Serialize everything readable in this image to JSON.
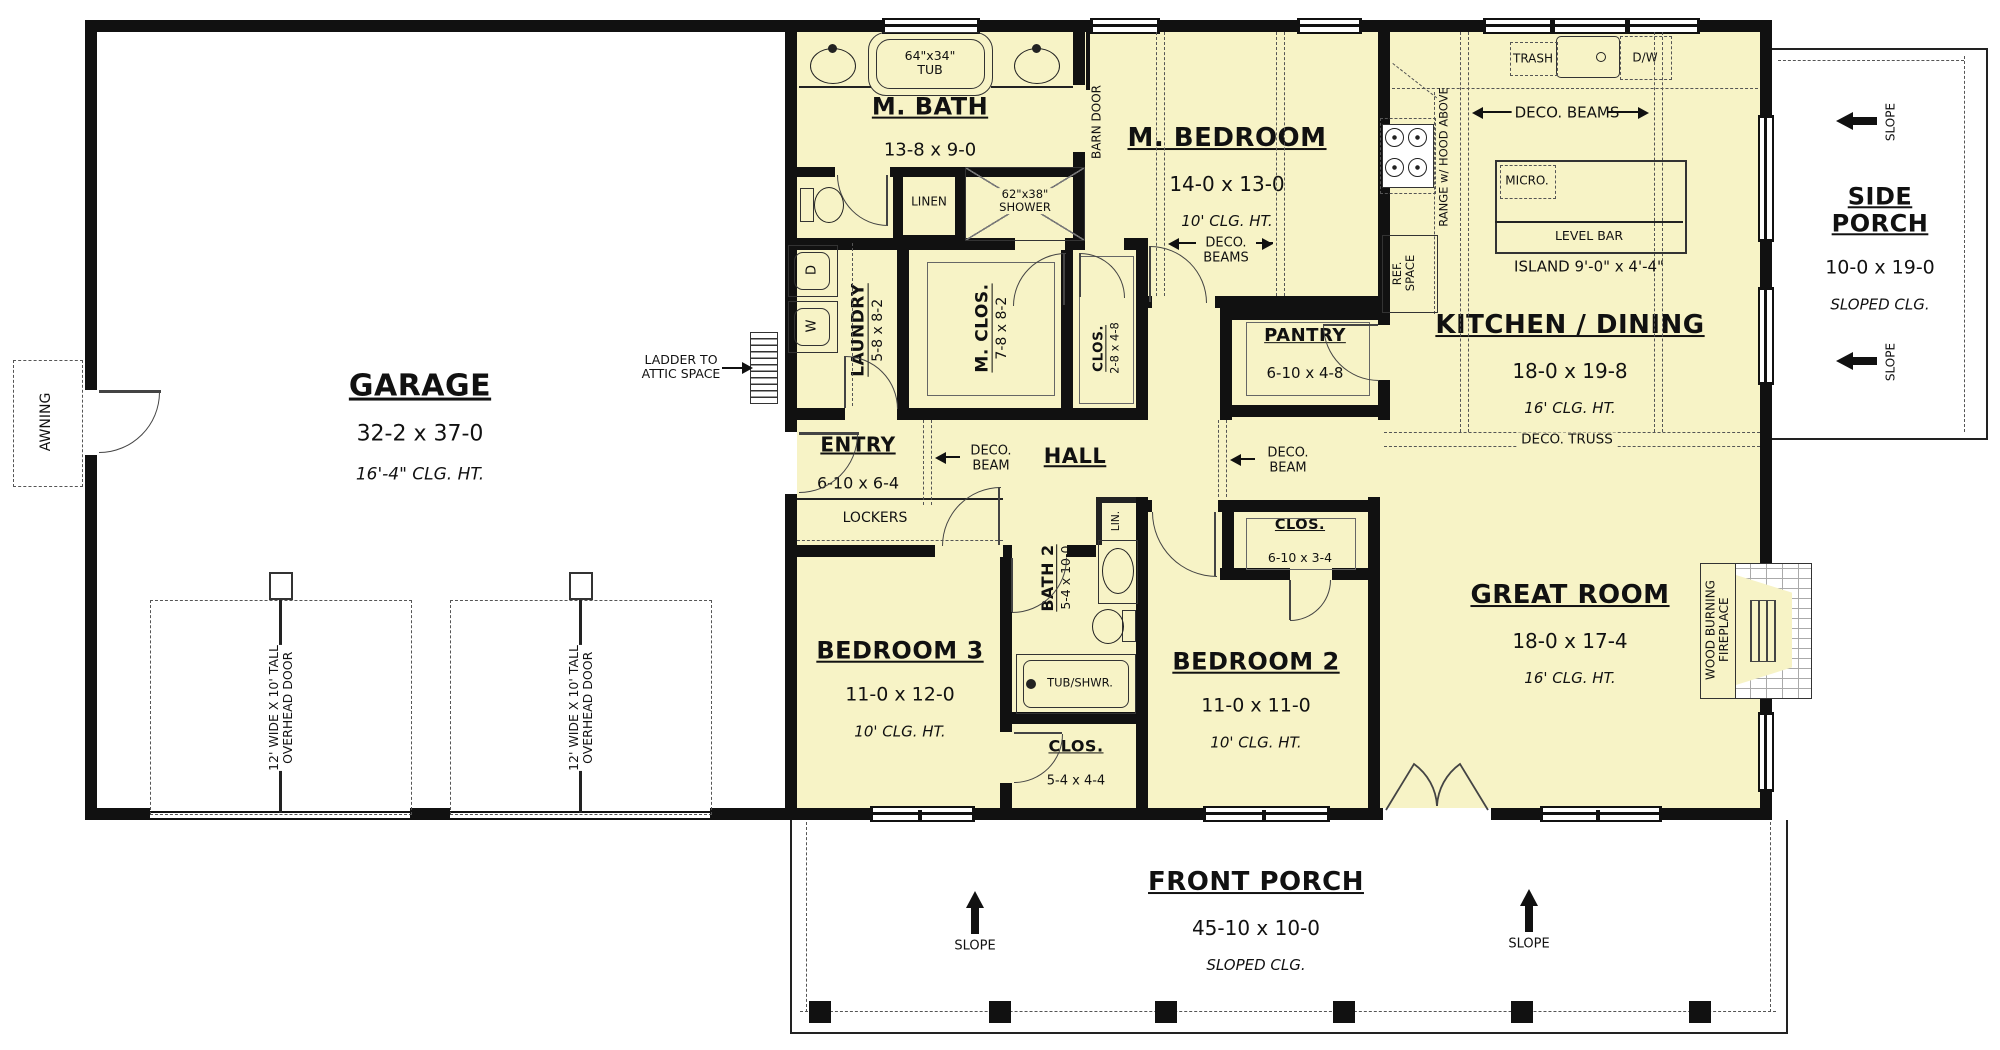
{
  "rooms": {
    "garage": {
      "name": "GARAGE",
      "dims": "32-2 x 37-0",
      "ceiling": "16'-4\" CLG. HT."
    },
    "m_bath": {
      "name": "M. BATH",
      "dims": "13-8 x 9-0"
    },
    "m_bedroom": {
      "name": "M. BEDROOM",
      "dims": "14-0 x 13-0",
      "ceiling": "10' CLG. HT."
    },
    "kitchen_dining": {
      "name": "KITCHEN / DINING",
      "dims": "18-0 x 19-8",
      "ceiling": "16' CLG. HT."
    },
    "side_porch": {
      "name": "SIDE PORCH",
      "dims": "10-0 x 19-0",
      "ceiling": "SLOPED CLG."
    },
    "great_room": {
      "name": "GREAT ROOM",
      "dims": "18-0 x 17-4",
      "ceiling": "16' CLG. HT."
    },
    "front_porch": {
      "name": "FRONT PORCH",
      "dims": "45-10 x 10-0",
      "ceiling": "SLOPED CLG."
    },
    "laundry": {
      "name": "LAUNDRY",
      "dims": "5-8 x 8-2"
    },
    "m_closet": {
      "name": "M. CLOS.",
      "dims": "7-8 x 8-2"
    },
    "hall_closet": {
      "name": "CLOS.",
      "dims": "2-8 x 4-8"
    },
    "pantry": {
      "name": "PANTRY",
      "dims": "6-10 x 4-8"
    },
    "entry": {
      "name": "ENTRY",
      "dims": "6-10 x 6-4"
    },
    "hall": {
      "name": "HALL"
    },
    "bedroom3": {
      "name": "BEDROOM 3",
      "dims": "11-0 x 12-0",
      "ceiling": "10' CLG. HT."
    },
    "bath2": {
      "name": "BATH 2",
      "dims": "5-4 x 10-0"
    },
    "bath2_closet": {
      "name": "CLOS.",
      "dims": "5-4 x 4-4"
    },
    "bedroom2": {
      "name": "BEDROOM 2",
      "dims": "11-0 x 11-0",
      "ceiling": "10' CLG. HT."
    },
    "bedroom2_closet": {
      "name": "CLOS.",
      "dims": "6-10 x 3-4"
    }
  },
  "fixtures": {
    "tub": "64\"x34\"\nTUB",
    "linen": "LINEN",
    "shower": "62\"x38\"\nSHOWER",
    "barn_door": "BARN DOOR",
    "trash": "TRASH",
    "dishwasher": "D/W",
    "microwave": "MICRO.",
    "level_bar": "LEVEL BAR",
    "island": "ISLAND 9'-0\" x 4'-4\"",
    "range": "RANGE w/ HOOD ABOVE",
    "ref_space": "REF.\nSPACE",
    "lockers": "LOCKERS",
    "linen_small": "LIN.",
    "tub_shower": "TUB/SHWR.",
    "fireplace": "WOOD BURNING\nFIREPLACE",
    "washer": "W",
    "dryer": "D"
  },
  "annotations": {
    "deco_beams": "DECO. BEAMS",
    "deco_beams_stacked": "DECO.\nBEAMS",
    "deco_beam": "DECO.\nBEAM",
    "deco_truss": "DECO. TRUSS",
    "slope": "SLOPE",
    "awning": "AWNING",
    "ladder": "LADDER TO\nATTIC SPACE",
    "overhead_door": "12' WIDE X 10' TALL\nOVERHEAD DOOR"
  },
  "colors": {
    "room_fill": "#F7F3C6",
    "wall": "#111111",
    "line": "#444444"
  }
}
